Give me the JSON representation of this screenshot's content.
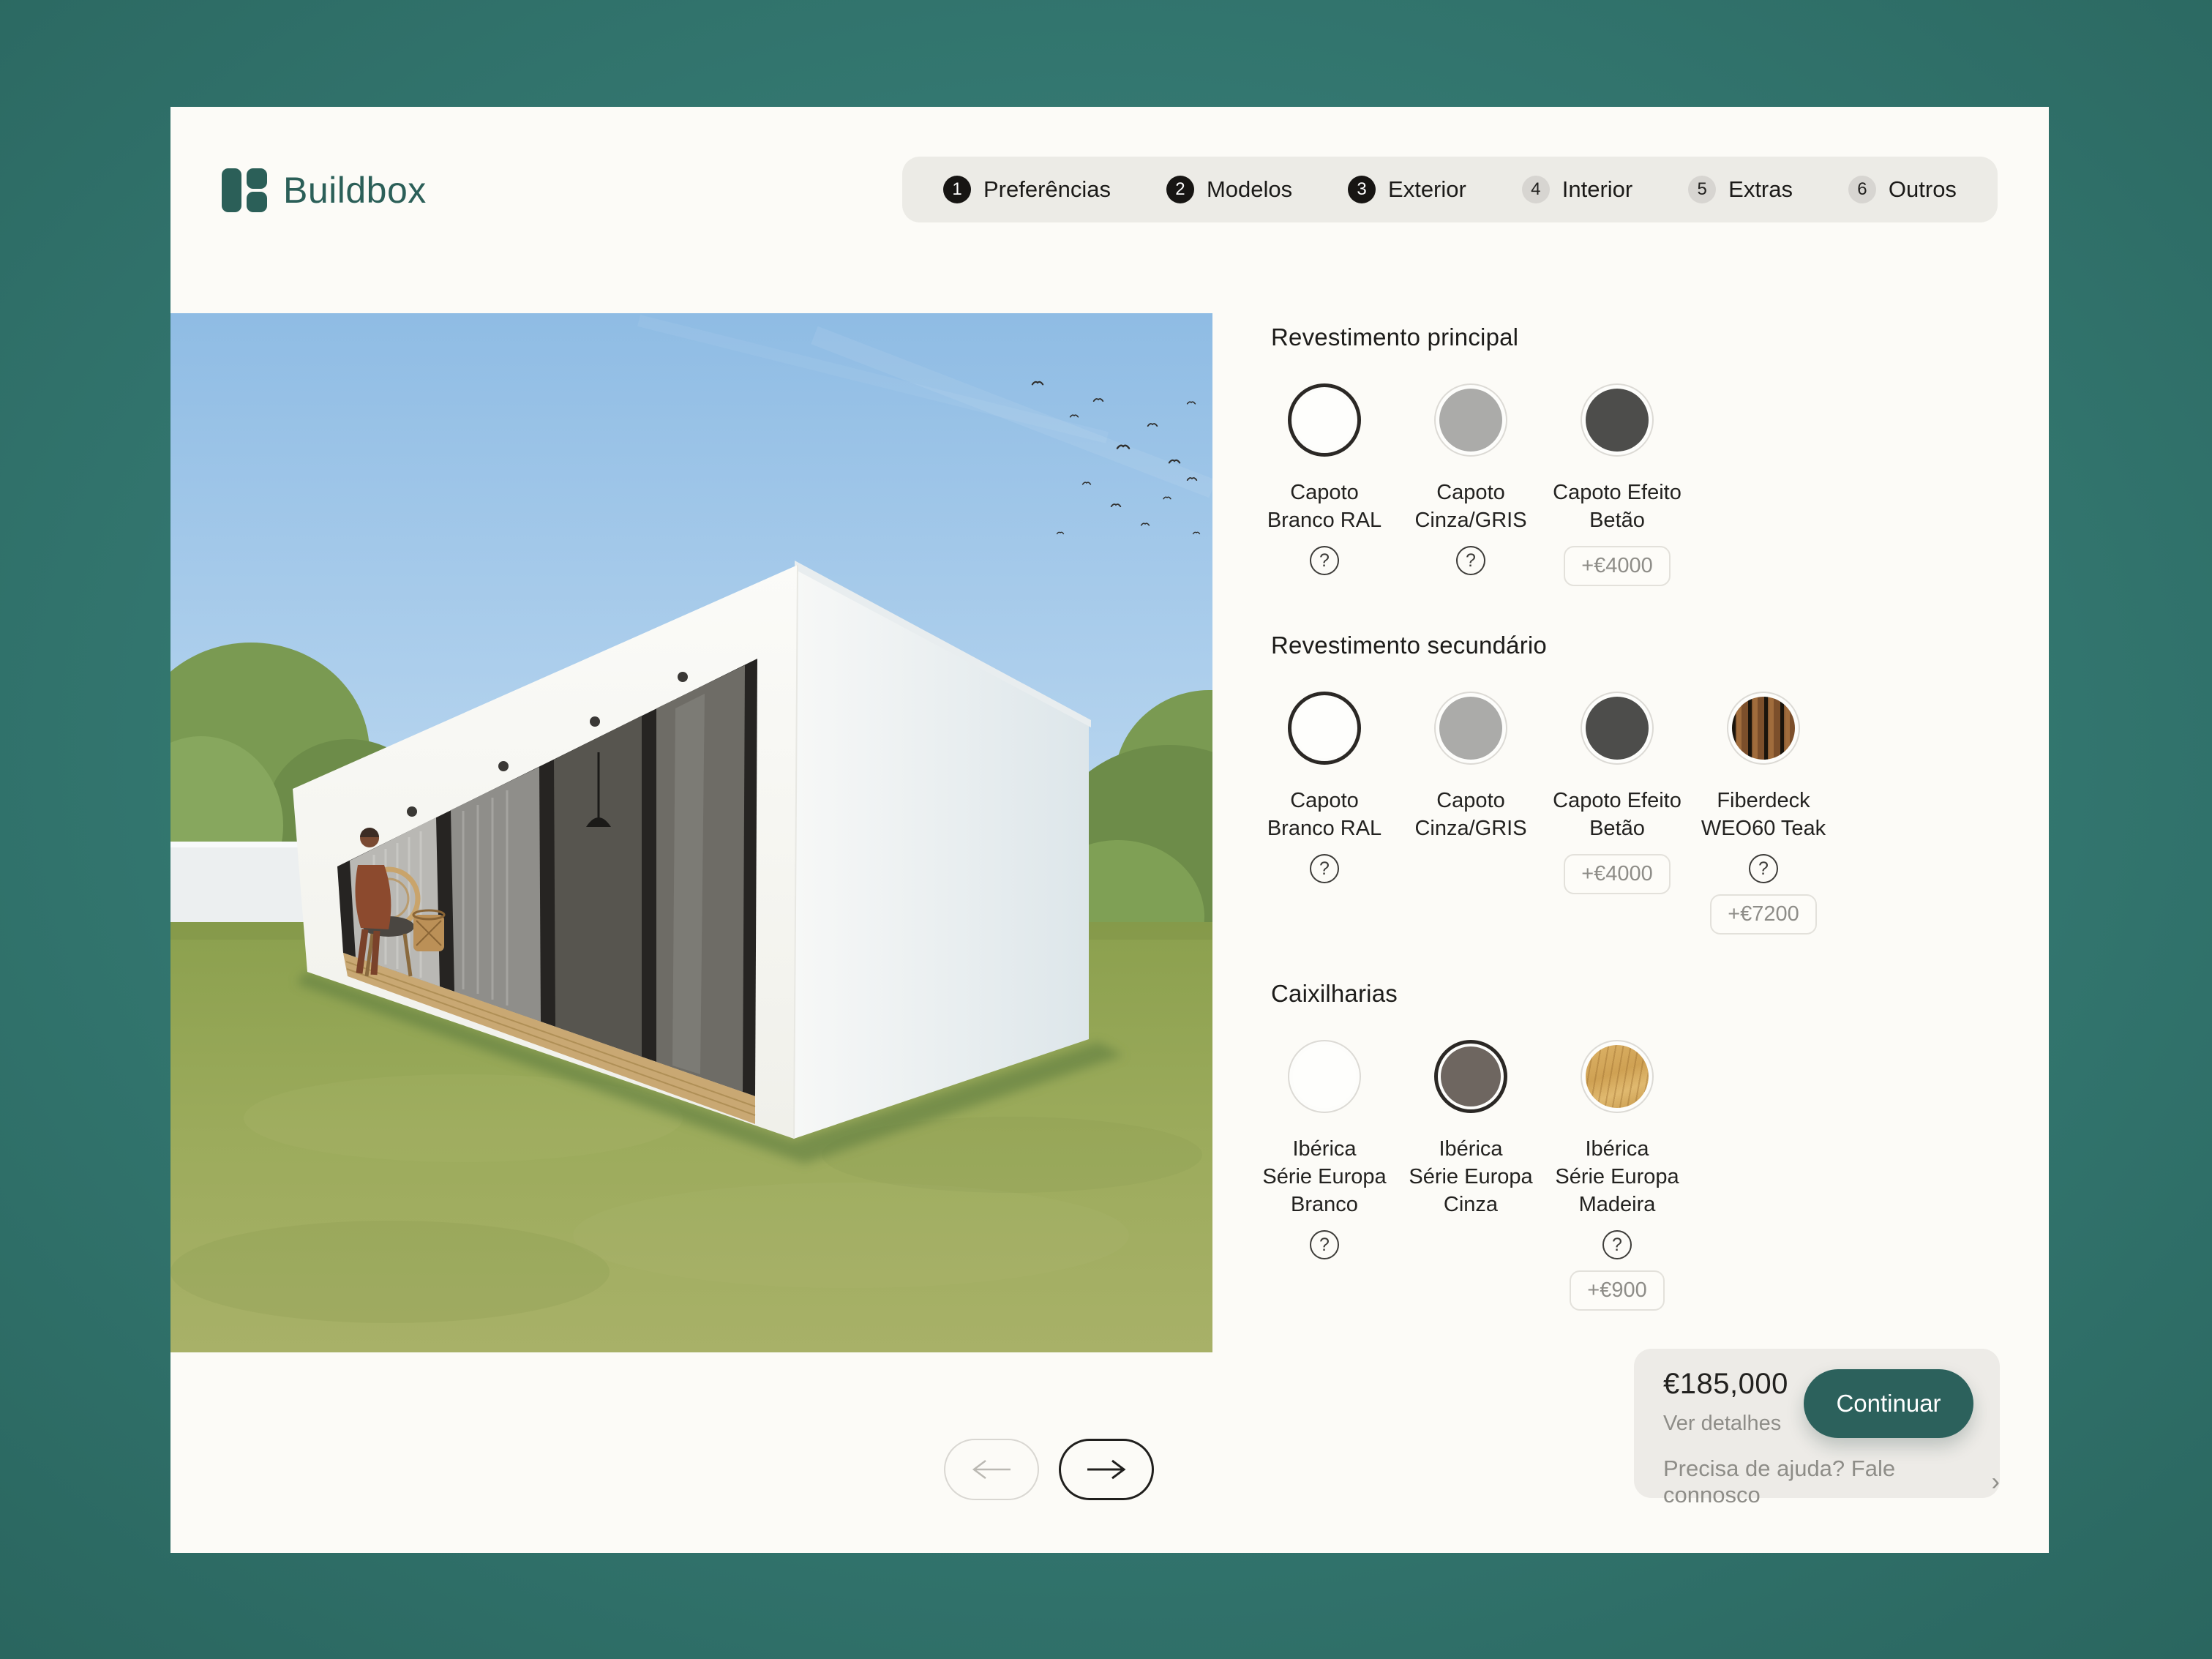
{
  "brand": {
    "name": "Buildbox"
  },
  "stepper": {
    "steps": [
      {
        "num": "1",
        "label": "Preferências",
        "state": "complete"
      },
      {
        "num": "2",
        "label": "Modelos",
        "state": "complete"
      },
      {
        "num": "3",
        "label": "Exterior",
        "state": "current"
      },
      {
        "num": "4",
        "label": "Interior",
        "state": "upcoming"
      },
      {
        "num": "5",
        "label": "Extras",
        "state": "upcoming"
      },
      {
        "num": "6",
        "label": "Outros",
        "state": "upcoming"
      }
    ]
  },
  "viewer": {
    "prev_enabled": false,
    "next_enabled": true
  },
  "configurator": {
    "help_glyph": "?",
    "sections": [
      {
        "title": "Revestimento principal",
        "options": [
          {
            "label_lines": [
              "Capoto",
              "Branco RAL"
            ],
            "swatch": {
              "type": "solid",
              "color": "#FEFEFC"
            },
            "selected": true,
            "help": true
          },
          {
            "label_lines": [
              "Capoto",
              "Cinza/GRIS"
            ],
            "swatch": {
              "type": "solid",
              "color": "#ABABA9"
            },
            "selected": false,
            "help": true
          },
          {
            "label_lines": [
              "Capoto Efeito",
              "Betão"
            ],
            "swatch": {
              "type": "solid",
              "color": "#4D4D4B"
            },
            "selected": false,
            "price": "+€4000"
          }
        ]
      },
      {
        "title": "Revestimento secundário",
        "options": [
          {
            "label_lines": [
              "Capoto",
              "Branco RAL"
            ],
            "swatch": {
              "type": "solid",
              "color": "#FEFEFC"
            },
            "selected": true,
            "help": true
          },
          {
            "label_lines": [
              "Capoto",
              "Cinza/GRIS"
            ],
            "swatch": {
              "type": "solid",
              "color": "#ABABA9"
            },
            "selected": false
          },
          {
            "label_lines": [
              "Capoto Efeito",
              "Betão"
            ],
            "swatch": {
              "type": "solid",
              "color": "#4D4D4B"
            },
            "selected": false,
            "price": "+€4000"
          },
          {
            "label_lines": [
              "Fiberdeck",
              "WEO60 Teak"
            ],
            "swatch": {
              "type": "teak"
            },
            "selected": false,
            "help": true,
            "price": "+€7200"
          }
        ]
      },
      {
        "title": "Caixilharias",
        "options": [
          {
            "label_lines": [
              "Ibérica",
              "Série Europa",
              "Branco"
            ],
            "swatch": {
              "type": "solid",
              "color": "#FEFEFC"
            },
            "selected": false,
            "help": true
          },
          {
            "label_lines": [
              "Ibérica",
              "Série Europa",
              "Cinza"
            ],
            "swatch": {
              "type": "solid",
              "color": "#6E6660"
            },
            "selected": true
          },
          {
            "label_lines": [
              "Ibérica",
              "Série Europa",
              "Madeira"
            ],
            "swatch": {
              "type": "oak"
            },
            "selected": false,
            "help": true,
            "price": "+€900"
          }
        ]
      }
    ]
  },
  "summary": {
    "price": "€185,000",
    "details_label": "Ver detalhes",
    "continue_label": "Continuar",
    "help_label": "Precisa de ajuda? Fale connosco",
    "help_chevron": "›"
  },
  "colors": {
    "background_teal": "#2F6F68",
    "card": "#FCFBF7",
    "stepper_bar": "#ECEBE6",
    "step_active": "#171513",
    "step_inactive": "#D7D5D1",
    "brand_accent": "#2B5F58",
    "continue_button": "#2C615C",
    "muted_text": "#8E8D88",
    "heading_text": "#1D1C1A",
    "selected_ring": "#2B2825",
    "unselected_ring": "#DCDAD5"
  }
}
